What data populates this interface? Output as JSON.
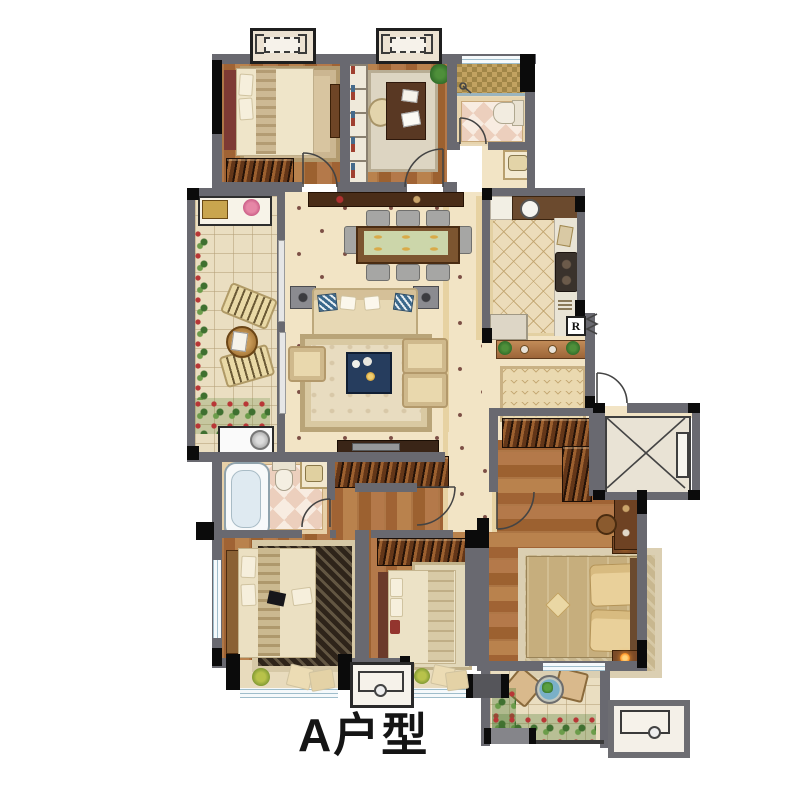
{
  "title": {
    "label": "A户型"
  },
  "labels": {
    "refrigerator": "R"
  },
  "colors": {
    "wall_gray": "#696970",
    "wall_black": "#0b0b0b",
    "wood_floor": "#ab7443",
    "tile_floor": "#f2e4c5",
    "hall_border": "#e7d2a2",
    "kitchen_floor": "#ecdcba",
    "balcony_floor": "#eadec1",
    "bath_checker_pink": "#eccfbd",
    "shower_mosaic": "#c2a261",
    "coffee_table_blue": "#263d5e",
    "shoe_console_copper": "#c28b58",
    "title_text": "#151515"
  },
  "rooms": [
    {
      "name": "bedroom-top-left",
      "furniture": [
        "bed",
        "rug",
        "wardrobe",
        "bench"
      ]
    },
    {
      "name": "study",
      "furniture": [
        "bookshelf",
        "desk",
        "office-chair",
        "rug",
        "plant"
      ]
    },
    {
      "name": "bathroom-top",
      "furniture": [
        "shower",
        "toilet",
        "wash-basin"
      ]
    },
    {
      "name": "balcony-left",
      "furniture": [
        "laundry-sink",
        "flower-bed",
        "lounge-chairs",
        "tea-table",
        "washing-machine"
      ]
    },
    {
      "name": "living-dining-room",
      "furniture": [
        "sideboard",
        "dining-table",
        "dining-chairs",
        "sofa",
        "pillows",
        "coffee-table",
        "armchairs",
        "speakers",
        "rug",
        "tv-cabinet"
      ]
    },
    {
      "name": "kitchen",
      "furniture": [
        "sink",
        "stove",
        "counters",
        "refrigerator"
      ]
    },
    {
      "name": "entry-foyer",
      "furniture": [
        "shoe-cabinet",
        "doormat",
        "entrance-door"
      ]
    },
    {
      "name": "elevator",
      "furniture": []
    },
    {
      "name": "walk-in-closet",
      "furniture": [
        "wardrobes"
      ]
    },
    {
      "name": "master-bedroom",
      "furniture": [
        "double-bed",
        "rug",
        "nightstands",
        "lamps",
        "desk",
        "stool"
      ]
    },
    {
      "name": "bedroom-bottom-middle",
      "furniture": [
        "bed",
        "rug",
        "wardrobe"
      ]
    },
    {
      "name": "bedroom-bottom-left",
      "furniture": [
        "bed",
        "rug",
        "dressing-table"
      ]
    },
    {
      "name": "bathroom-bottom",
      "furniture": [
        "bathtub",
        "toilet",
        "wash-basin"
      ]
    },
    {
      "name": "balcony-bottom-right",
      "furniture": [
        "chairs",
        "round-table",
        "plants"
      ]
    },
    {
      "name": "bay-windows",
      "furniture": [
        "cushions",
        "plants"
      ]
    },
    {
      "name": "ac-platforms",
      "furniture": [
        "ac-outdoor-unit"
      ]
    }
  ]
}
